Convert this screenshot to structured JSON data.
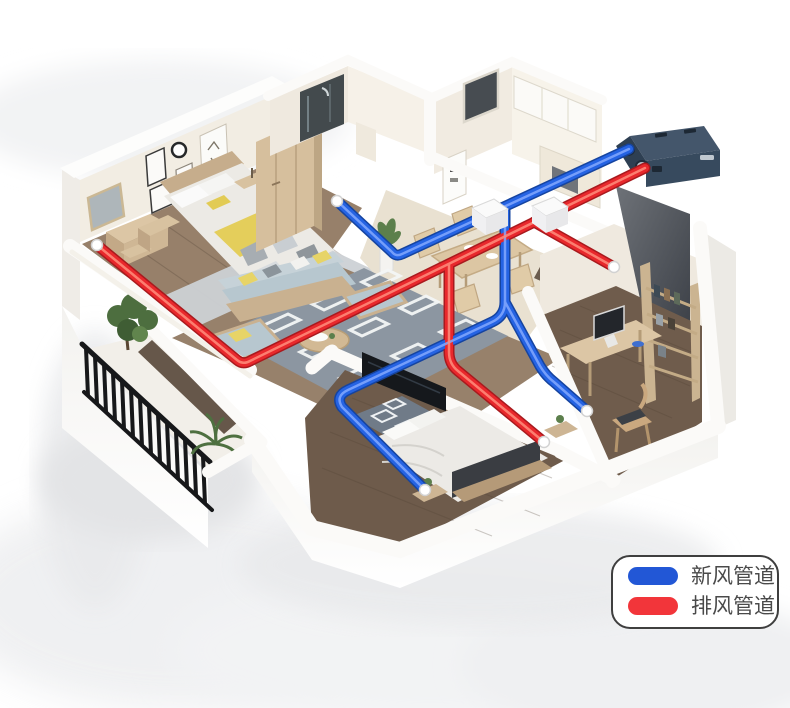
{
  "scene": {
    "kind": "isometric-apartment-ventilation-cutaway",
    "rooms": [
      "master-bedroom",
      "bathroom",
      "kitchen",
      "dining-room",
      "living-room",
      "second-bedroom",
      "study",
      "balcony"
    ],
    "vent_count": 6,
    "junction_box_count": 2
  },
  "unit": {
    "name": "heat-recovery-ventilation-unit",
    "body_color": "#3c4f63",
    "panel_color": "#4a4f56"
  },
  "pipes": {
    "fresh": {
      "label_ref": "legend.items.0.label",
      "color": "#2563e3",
      "outline": "#16449f",
      "sheen": "#84a9ff"
    },
    "exhaust": {
      "label_ref": "legend.items.1.label",
      "color": "#e8282c",
      "outline": "#a81a1e",
      "sheen": "#ff8d7d"
    }
  },
  "legend": {
    "items": [
      {
        "label": "新风管道",
        "color": "#2257d6"
      },
      {
        "label": "排风管道",
        "color": "#f2353a"
      }
    ],
    "border_color": "#3f3f3f",
    "text_color": "#4a4a4a"
  }
}
